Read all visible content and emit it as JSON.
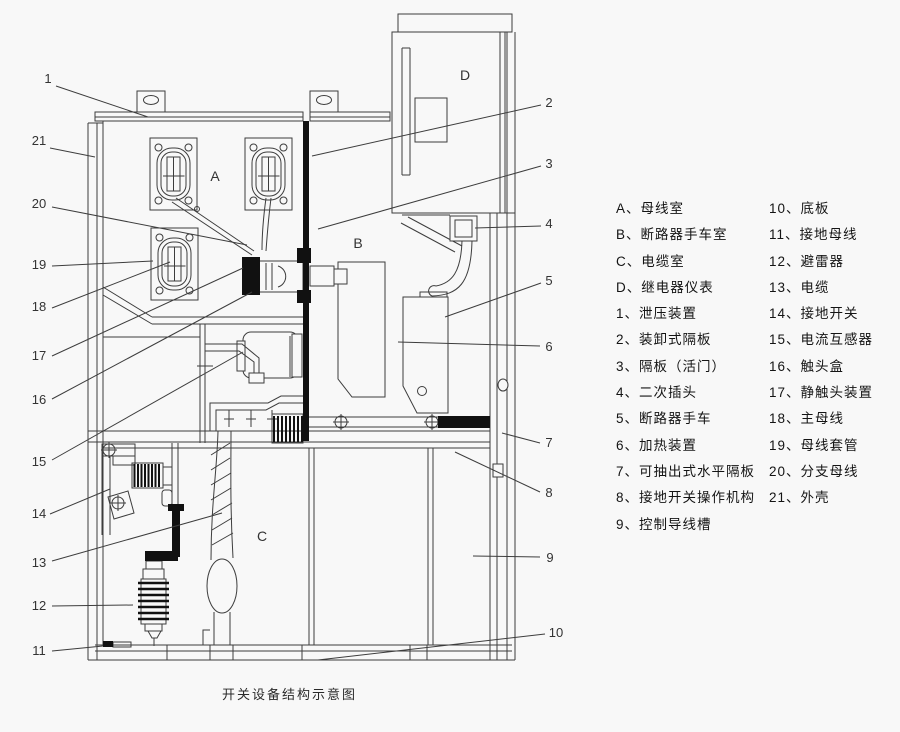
{
  "caption": "开关设备结构示意图",
  "colors": {
    "background": "#f8f8f8",
    "line": "#3d3d3d",
    "solid_black": "#111111",
    "text": "#141414"
  },
  "diagram": {
    "compartment_labels": [
      "A",
      "B",
      "C",
      "D"
    ],
    "callouts": [
      "1",
      "2",
      "3",
      "4",
      "5",
      "6",
      "7",
      "8",
      "9",
      "10",
      "11",
      "12",
      "13",
      "14",
      "15",
      "16",
      "17",
      "18",
      "19",
      "20",
      "21"
    ]
  },
  "legend": {
    "left": [
      "A、母线室",
      "B、断路器手车室",
      "C、电缆室",
      "D、继电器仪表",
      "1、泄压装置",
      "2、装卸式隔板",
      "3、隔板（活门）",
      "4、二次插头",
      "5、断路器手车",
      "6、加热装置",
      "7、可抽出式水平隔板",
      "8、接地开关操作机构",
      "9、控制导线槽"
    ],
    "right": [
      "10、底板",
      "11、接地母线",
      "12、避雷器",
      "13、电缆",
      "14、接地开关",
      "15、电流互感器",
      "16、触头盒",
      "17、静触头装置",
      "18、主母线",
      "19、母线套管",
      "20、分支母线",
      "21、外壳"
    ]
  }
}
